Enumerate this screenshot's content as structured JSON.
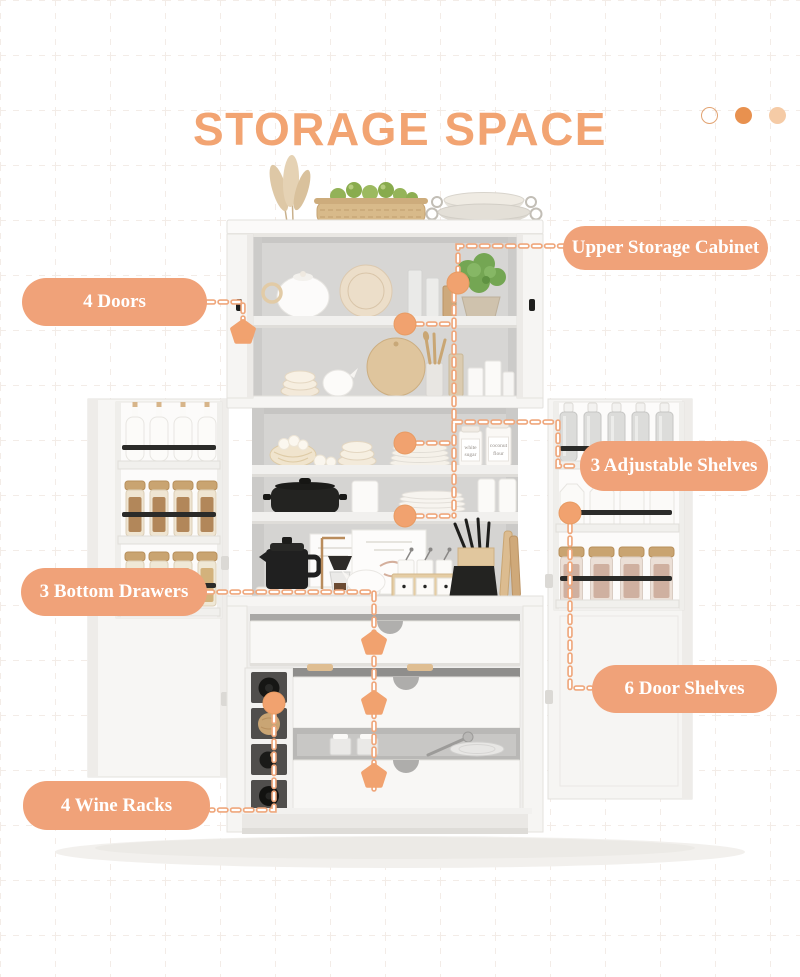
{
  "title": "STORAGE SPACE",
  "decor_dots": {
    "count": 3,
    "styles": [
      "outline",
      "solid",
      "light"
    ]
  },
  "callouts": {
    "upper_storage_cabinet": "Upper Storage Cabinet",
    "four_doors": "4 Doors",
    "adjustable_shelves": "3 Adjustable Shelves",
    "bottom_drawers": "3 Bottom Drawers",
    "door_shelves": "6 Door Shelves",
    "wine_racks": "4 Wine Racks"
  },
  "jars": {
    "sugar_line1": "white",
    "sugar_line2": "sugar",
    "flour_line1": "coconut",
    "flour_line2": "flour"
  },
  "colors": {
    "accent": "#F2A472",
    "badge_bg": "#F0A279",
    "badge_text": "#FFFFFF",
    "dash": "#EFA77C",
    "marker": "#F1A26F",
    "dot_solid": "#E8914F",
    "dot_light": "#F5CBA6",
    "dot_outline": "#E2A372"
  }
}
